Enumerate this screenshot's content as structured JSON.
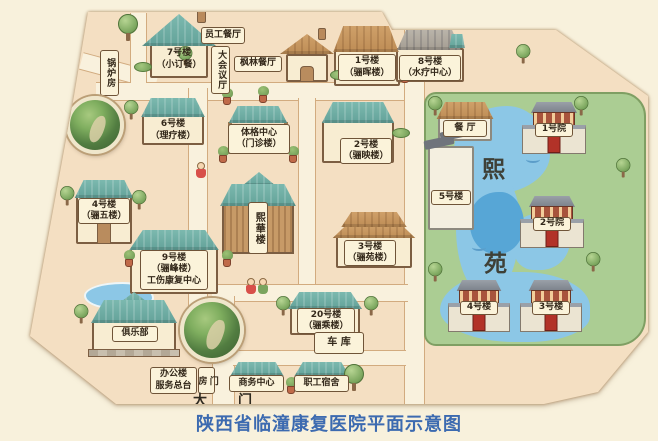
{
  "title": {
    "text": "陕西省临潼康复医院平面示意图",
    "color": "#3c6ab0"
  },
  "map": {
    "gate": {
      "left_char": "大",
      "right_char": "门"
    },
    "buildings": {
      "boiler_room": {
        "label": "锅炉房"
      },
      "b7": {
        "name": "7号楼",
        "alias": "（小订餐）"
      },
      "staff_canteen": {
        "label": "员工餐厅"
      },
      "conference_hall": {
        "label": "大会议厅"
      },
      "fenglin_restaurant": {
        "label": "枫林餐厅"
      },
      "b1": {
        "name": "1号楼",
        "alias": "（骊晖楼）"
      },
      "b8": {
        "name": "8号楼",
        "alias": "（水疗中心）"
      },
      "b6": {
        "name": "6号楼",
        "alias": "（理疗楼）"
      },
      "physique_center": {
        "name": "体格中心",
        "alias": "（门诊楼）"
      },
      "b2": {
        "name": "2号楼",
        "alias": "（骊映楼）"
      },
      "b4": {
        "name": "4号楼",
        "alias": "（骊五楼）"
      },
      "xihua_tower": {
        "label": "熙華楼"
      },
      "b9": {
        "name": "9号楼",
        "alias": "（骊峰楼）",
        "dept": "工伤康复中心"
      },
      "b3": {
        "name": "3号楼",
        "alias": "（骊苑楼）"
      },
      "b20": {
        "name": "20号楼",
        "alias": "（骊乘楼）"
      },
      "club": {
        "label": "俱乐部"
      },
      "garage": {
        "label": "车 库"
      },
      "office_building": {
        "line1": "办公楼",
        "line2": "服务总台"
      },
      "gatehouse": {
        "label": "门房"
      },
      "business_center": {
        "label": "商务中心"
      },
      "staff_dorm": {
        "label": "职工宿舍"
      }
    },
    "garden": {
      "name_top": "熙",
      "name_bottom": "苑",
      "dining_hall": {
        "label": "餐 厅"
      },
      "b5": {
        "label": "5号楼"
      },
      "yard1": {
        "label": "1号院"
      },
      "yard2": {
        "label": "2号院"
      },
      "yard3": {
        "label": "3号楼"
      },
      "yard4": {
        "label": "4号楼"
      }
    }
  },
  "icons": {
    "tree-icon": "css-green-circle-with-trunk",
    "potted-plant-icon": "css-green-puff-terracotta-pot",
    "bush-icon": "css-green-ellipse",
    "garden-photo-inset": "css-circle-photo",
    "pond-icon": "css-blue-blob",
    "wave-icon": "css-arc",
    "child-figure-icon": "css-head-and-body",
    "chimney-icon": "css-brown-rect"
  },
  "colors": {
    "background": "#f8f1dc",
    "land": "#f4dfc2",
    "road": "#f9f1dd",
    "garden_green": "#abcd93",
    "water": "#8cc7e6",
    "water_dark": "#57a6d6",
    "roof_teal": "#72b0a7",
    "roof_brown": "#c99a63",
    "label_bg": "#fbf3da",
    "outline_brown": "#7c5e42",
    "title_blue": "#3c6ab0"
  }
}
